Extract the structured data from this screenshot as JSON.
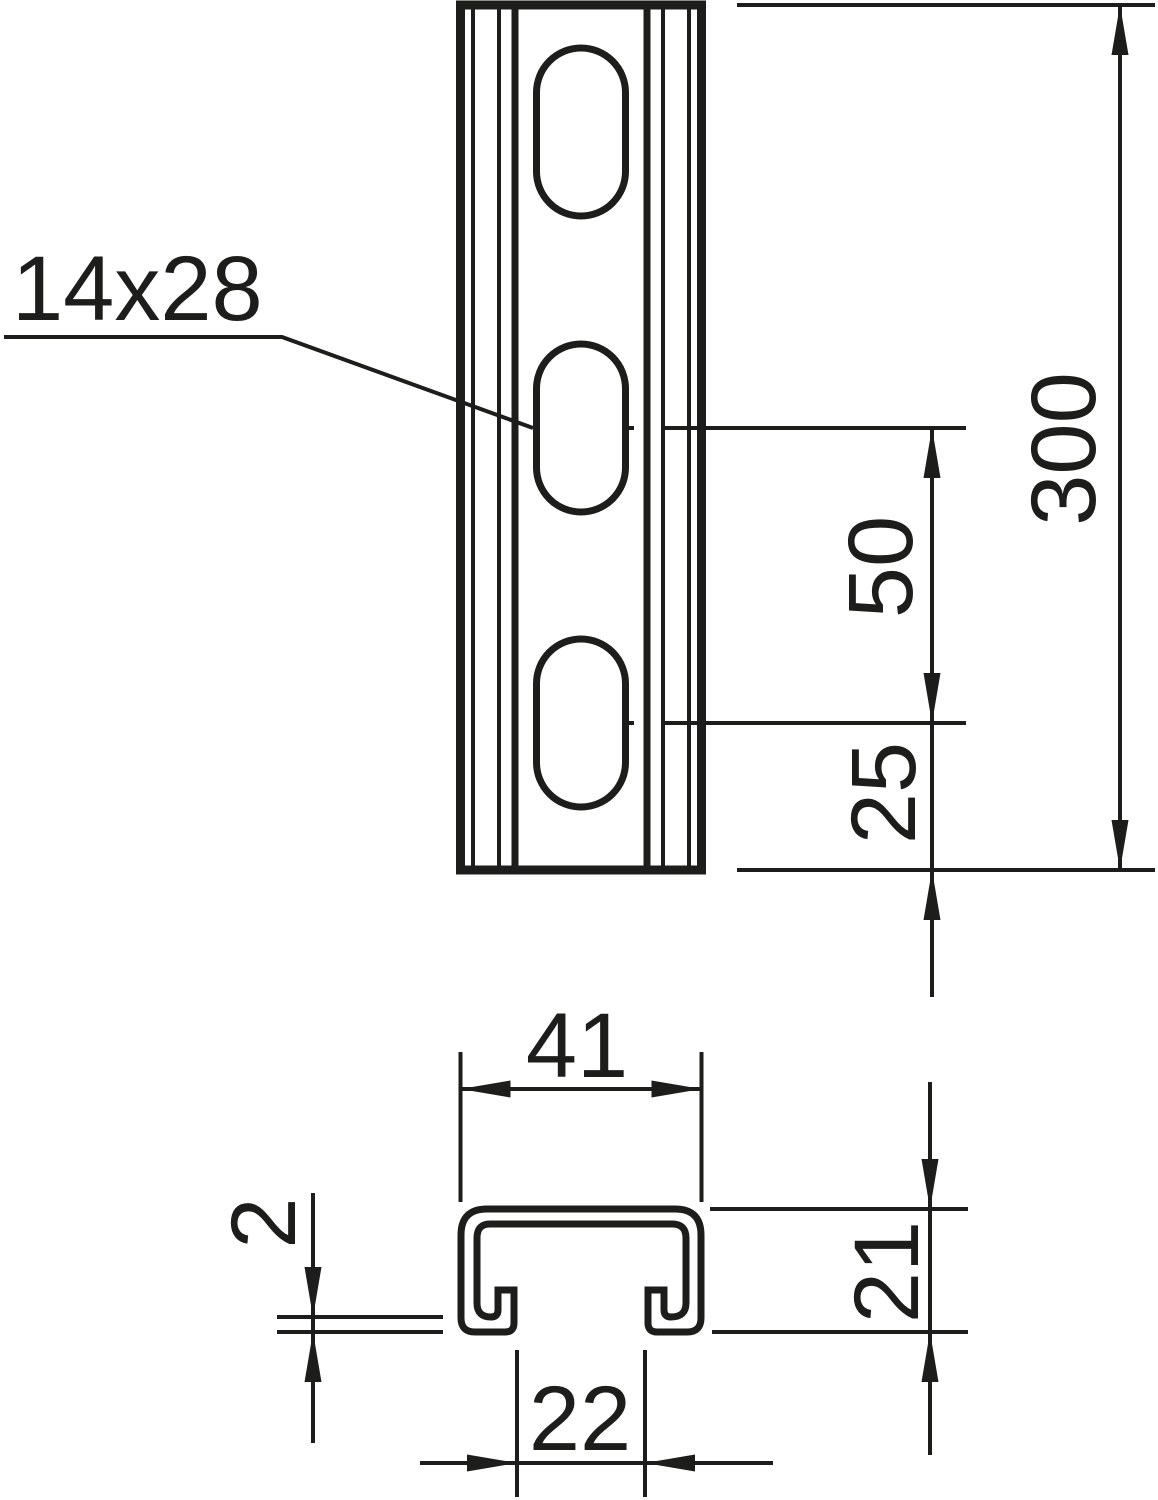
{
  "drawing": {
    "background": "#ffffff",
    "line_color": "#1d1d1b",
    "front_view": {
      "slot_size_label": "14x28",
      "total_length": "300",
      "slot_pitch": "50",
      "end_offset": "25"
    },
    "section_view": {
      "outer_width": "41",
      "profile_height": "21",
      "opening_width": "22",
      "material_thickness": "2"
    }
  }
}
